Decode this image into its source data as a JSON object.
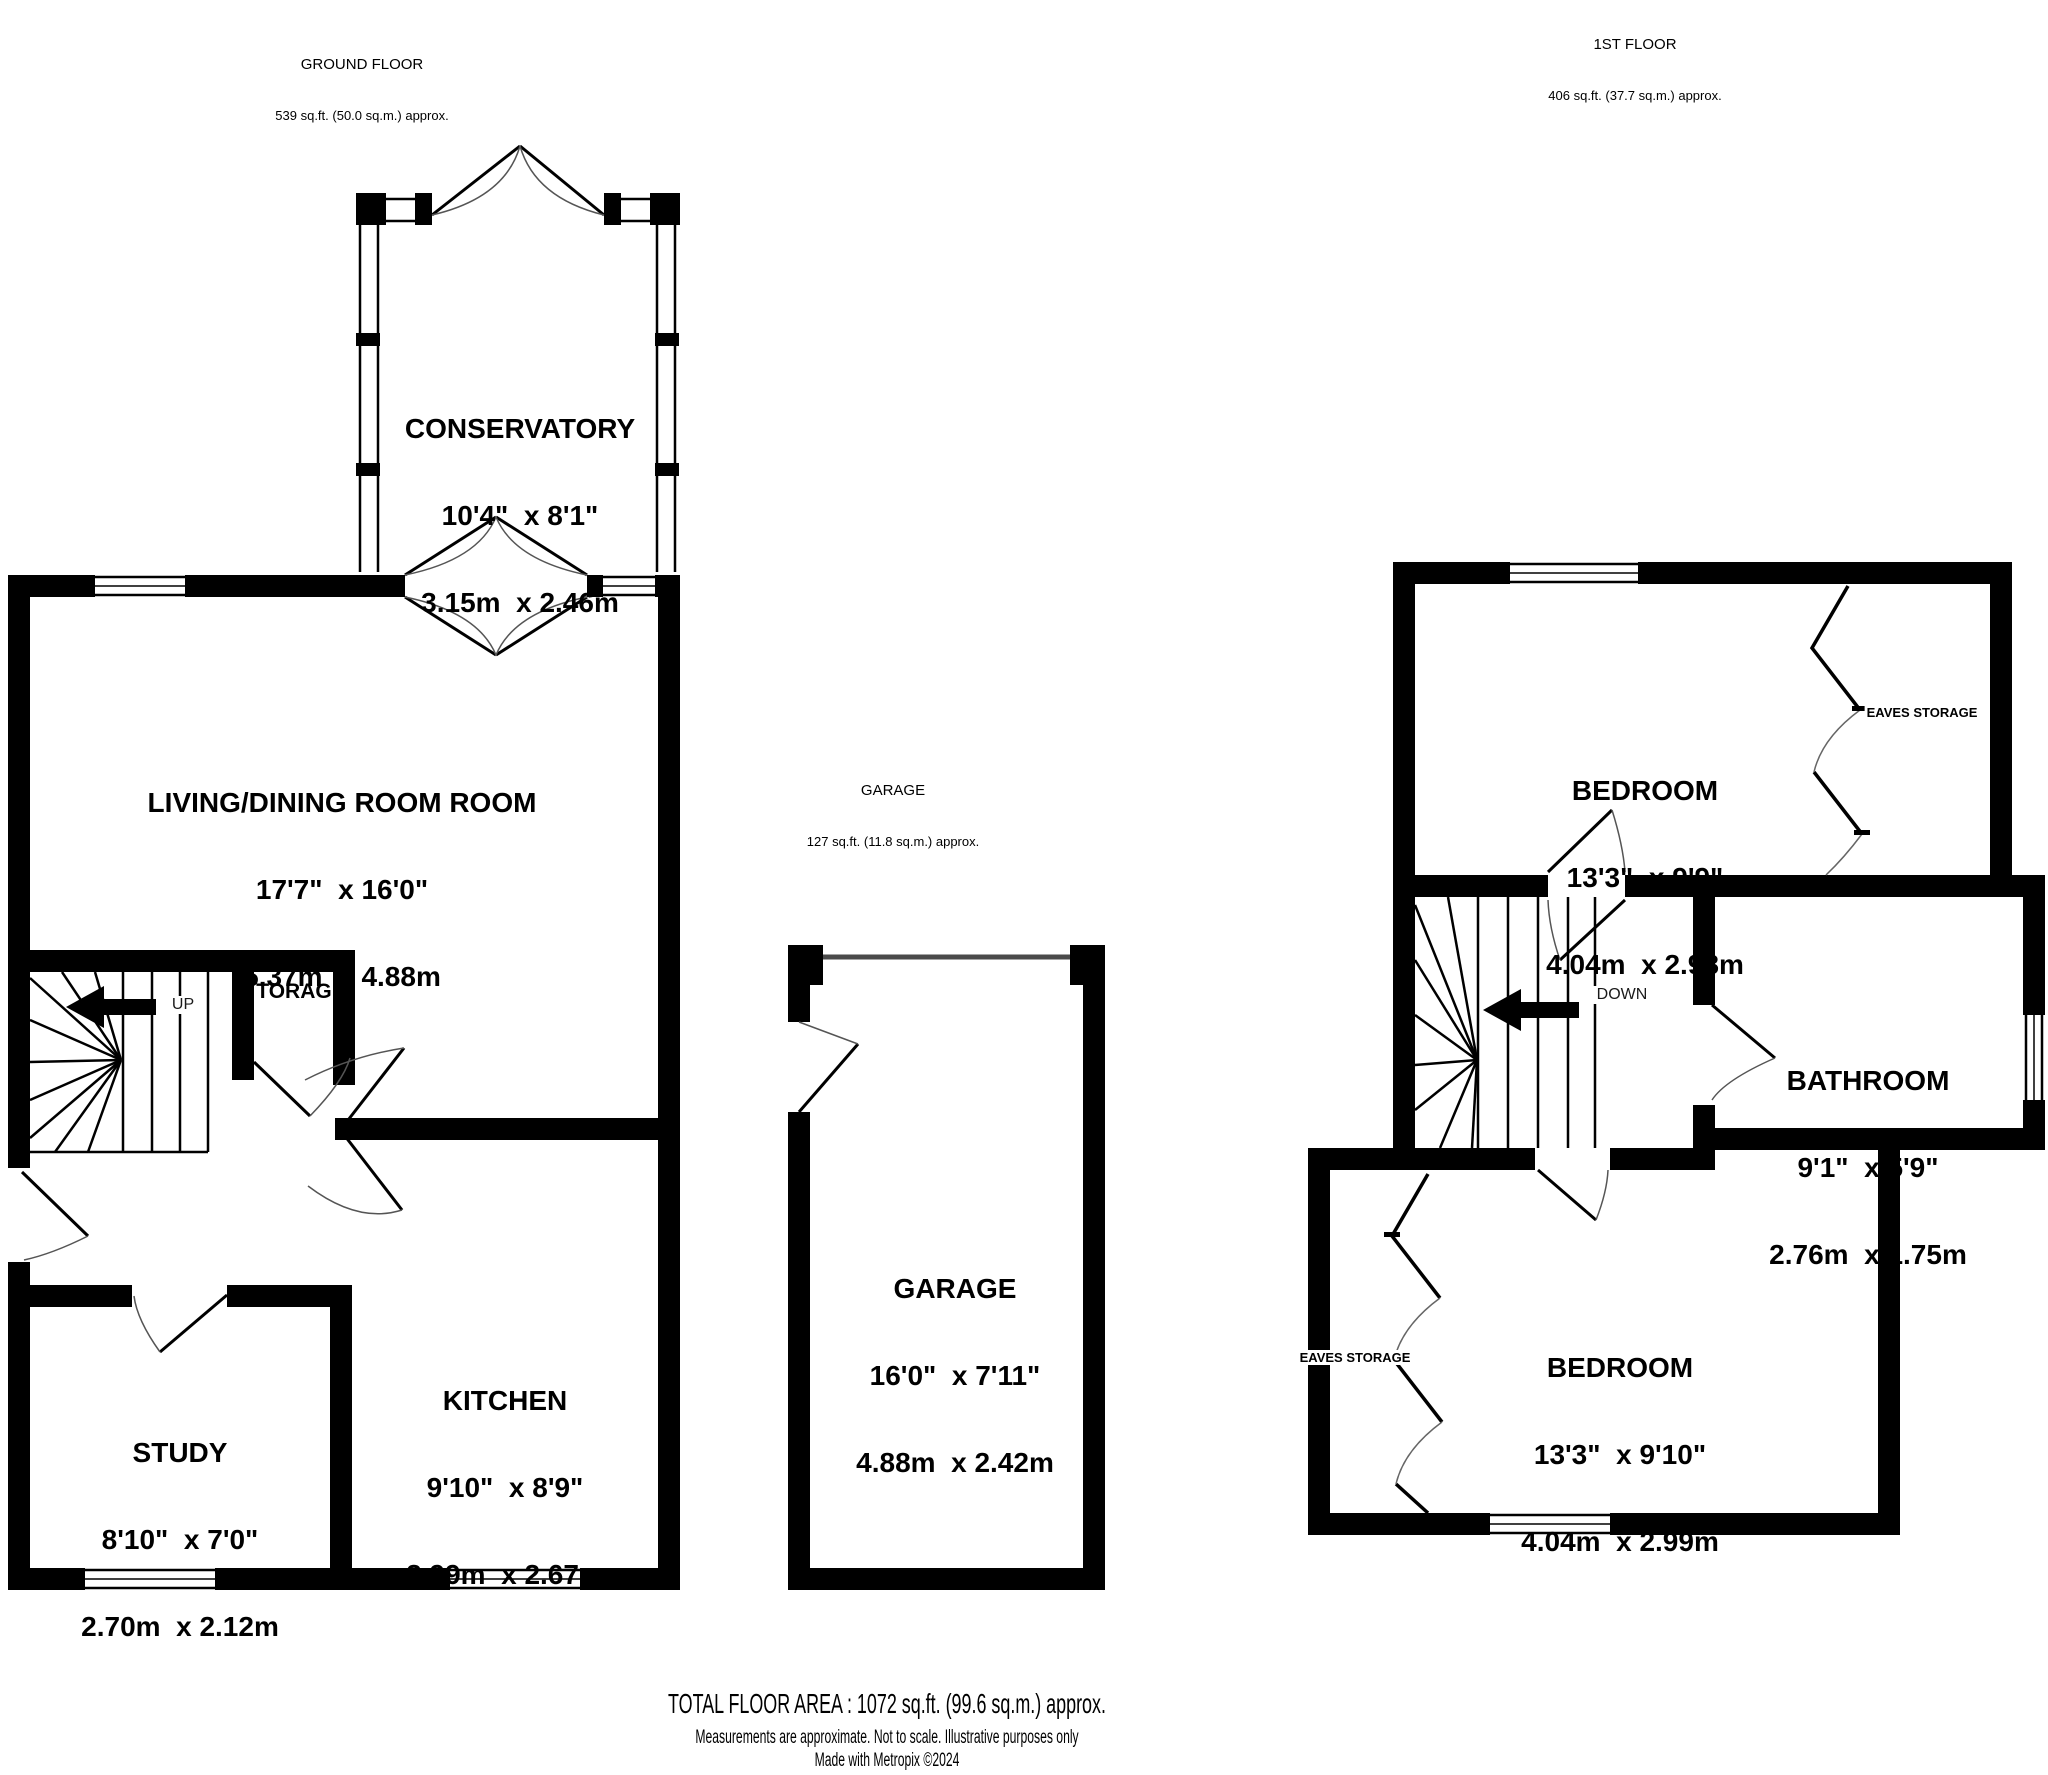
{
  "headers": {
    "ground_floor": {
      "title": "GROUND FLOOR",
      "area": "539 sq.ft. (50.0 sq.m.) approx."
    },
    "first_floor": {
      "title": "1ST FLOOR",
      "area": "406 sq.ft. (37.7 sq.m.) approx."
    },
    "garage_note": {
      "title": "GARAGE",
      "area": "127 sq.ft. (11.8 sq.m.) approx."
    }
  },
  "rooms": {
    "conservatory": {
      "name": "CONSERVATORY",
      "imperial": "10'4\"  x 8'1\"",
      "metric": "3.15m  x 2.46m"
    },
    "living_dining": {
      "name": "LIVING/DINING ROOM ROOM",
      "imperial": "17'7\"  x 16'0\"",
      "metric": "5.37m  x 4.88m"
    },
    "study": {
      "name": "STUDY",
      "imperial": "8'10\"  x 7'0\"",
      "metric": "2.70m  x 2.12m"
    },
    "kitchen": {
      "name": "KITCHEN",
      "imperial": "9'10\"  x 8'9\"",
      "metric": "2.99m  x 2.67m"
    },
    "garage": {
      "name": "GARAGE",
      "imperial": "16'0\"  x 7'11\"",
      "metric": "4.88m  x 2.42m"
    },
    "bedroom1": {
      "name": "BEDROOM",
      "imperial": "13'3\"  x 9'9\"",
      "metric": "4.04m  x 2.98m"
    },
    "bathroom": {
      "name": "BATHROOM",
      "imperial": "9'1\"  x 5'9\"",
      "metric": "2.76m  x 1.75m"
    },
    "bedroom2": {
      "name": "BEDROOM",
      "imperial": "13'3\"  x 9'10\"",
      "metric": "4.04m  x 2.99m"
    }
  },
  "annotations": {
    "up": "UP",
    "down": "DOWN",
    "storage_clipped": "TORAG",
    "eaves_top": "EAVES STORAGE",
    "eaves_bottom": "EAVES STORAGE"
  },
  "footer": {
    "total": "TOTAL FLOOR AREA : 1072 sq.ft. (99.6 sq.m.) approx.",
    "disclaimer": "Measurements are approximate.  Not to scale.  Illustrative purposes only",
    "credit": "Made with Metropix ©2024"
  },
  "colors": {
    "wall": "#000000",
    "background": "#ffffff",
    "garage_door": "#4a4a4a",
    "door_arc": "#444444"
  }
}
